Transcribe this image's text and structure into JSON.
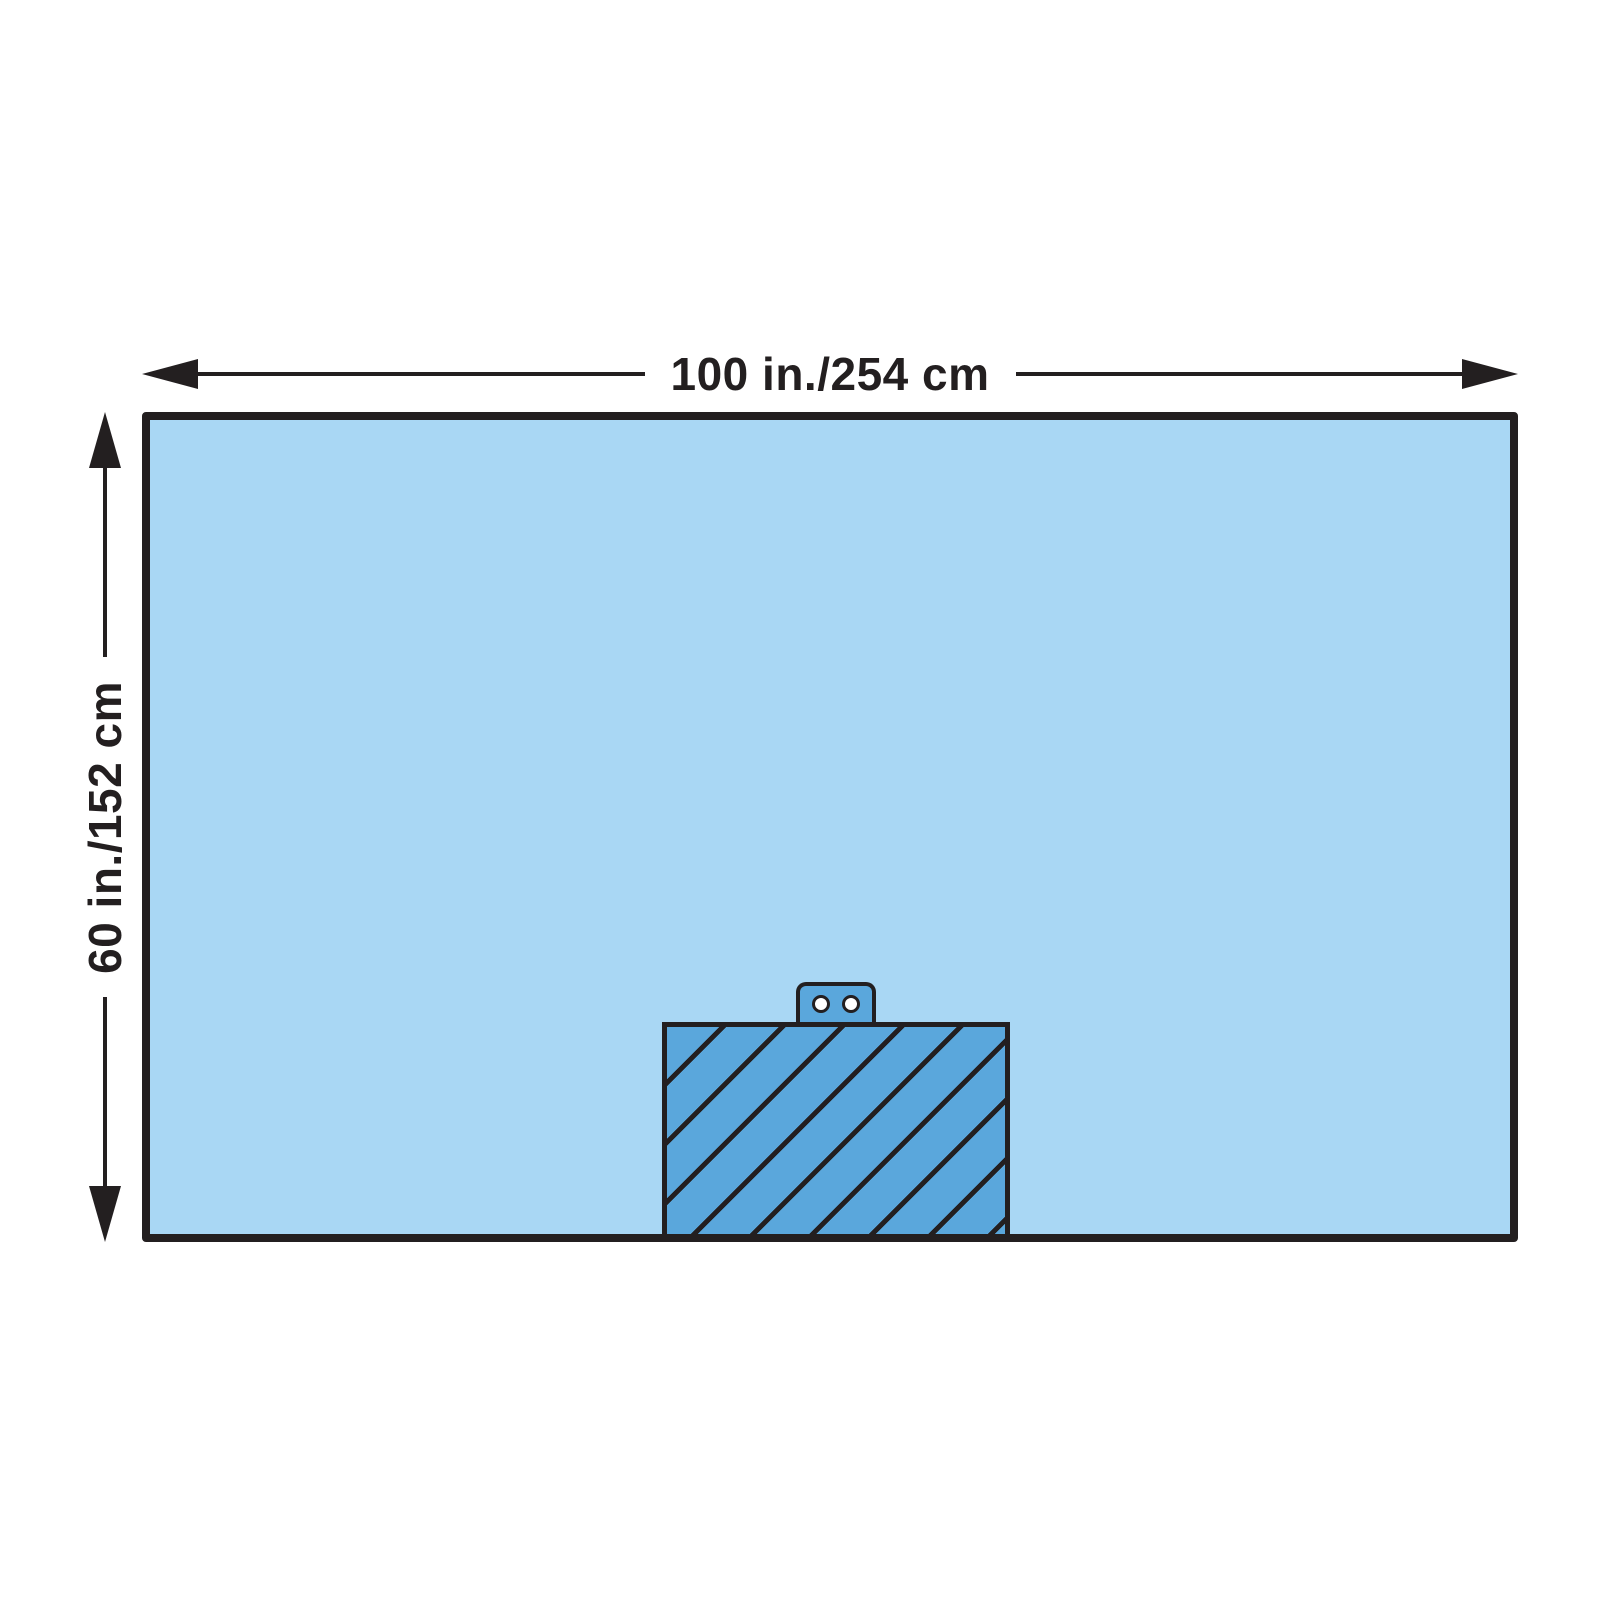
{
  "diagram": {
    "kind": "surgical-drape-dimension-diagram",
    "width_label": "100 in./254 cm",
    "height_label": "60 in./152 cm",
    "features": {
      "reinforcement_zone": "diagonal-hatched patch at bottom center of drape",
      "tube_holder_tab": "rounded tab with 2 holes centered above the patch",
      "hatch_angle_deg": 45
    },
    "colors": {
      "background": "#FFFFFF",
      "drape_fill": "#A9D7F4",
      "patch_fill": "#5AA7DC",
      "ink": "#231F20",
      "hole_fill": "#FFFFFF"
    }
  }
}
